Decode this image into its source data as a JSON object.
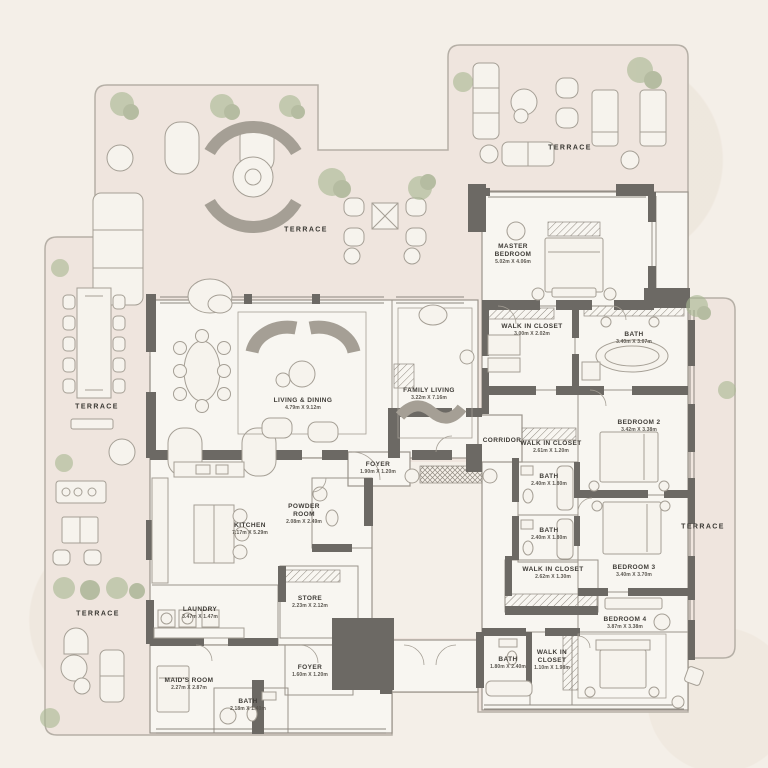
{
  "plan": {
    "rooms": [
      {
        "name": "MASTER BEDROOM",
        "dims": "5.02m X 4.06m"
      },
      {
        "name": "WALK IN CLOSET",
        "dims": "3.00m X 2.02m"
      },
      {
        "name": "BATH",
        "dims": "3.40m X 3.07m"
      },
      {
        "name": "BEDROOM 2",
        "dims": "3.42m X 3.38m"
      },
      {
        "name": "CORRIDOR",
        "dims": ""
      },
      {
        "name": "WALK IN CLOSET",
        "dims": "2.61m X 1.20m"
      },
      {
        "name": "BATH",
        "dims": "2.40m X 1.80m"
      },
      {
        "name": "BATH",
        "dims": "2.40m X 1.80m"
      },
      {
        "name": "WALK IN CLOSET",
        "dims": "2.62m X 1.30m"
      },
      {
        "name": "BEDROOM 3",
        "dims": "3.40m X 3.70m"
      },
      {
        "name": "BEDROOM 4",
        "dims": "3.87m X 3.38m"
      },
      {
        "name": "WALK IN CLOSET",
        "dims": "1.10m X 1.98m"
      },
      {
        "name": "BATH",
        "dims": "1.80m X 2.40m"
      },
      {
        "name": "LIVING & DINING",
        "dims": "4.79m X 9.12m"
      },
      {
        "name": "FAMILY LIVING",
        "dims": "3.22m X 7.16m"
      },
      {
        "name": "FOYER",
        "dims": "1.90m X 1.20m"
      },
      {
        "name": "POWDER ROOM",
        "dims": "2.08m X 2.49m"
      },
      {
        "name": "KITCHEN",
        "dims": "7.17m X 5.29m"
      },
      {
        "name": "STORE",
        "dims": "2.23m X 2.12m"
      },
      {
        "name": "LAUNDRY",
        "dims": "3.47m X 1.47m"
      },
      {
        "name": "MAID'S ROOM",
        "dims": "2.27m X 2.87m"
      },
      {
        "name": "BATH",
        "dims": "2.18m X 1.40m"
      },
      {
        "name": "FOYER",
        "dims": "1.60m X 1.20m"
      }
    ],
    "terraces": [
      {
        "label": "TERRACE"
      },
      {
        "label": "TERRACE"
      },
      {
        "label": "TERRACE"
      },
      {
        "label": "TERRACE"
      },
      {
        "label": "TERRACE"
      }
    ],
    "colors": {
      "background": "#f4efe8",
      "terrace_fill": "#efe5de",
      "room_fill": "#f8f6f1",
      "wall": "#6c6964",
      "furniture_line": "#a59f95",
      "tree": "#a9b893",
      "label_text": "#3f3c37"
    }
  }
}
